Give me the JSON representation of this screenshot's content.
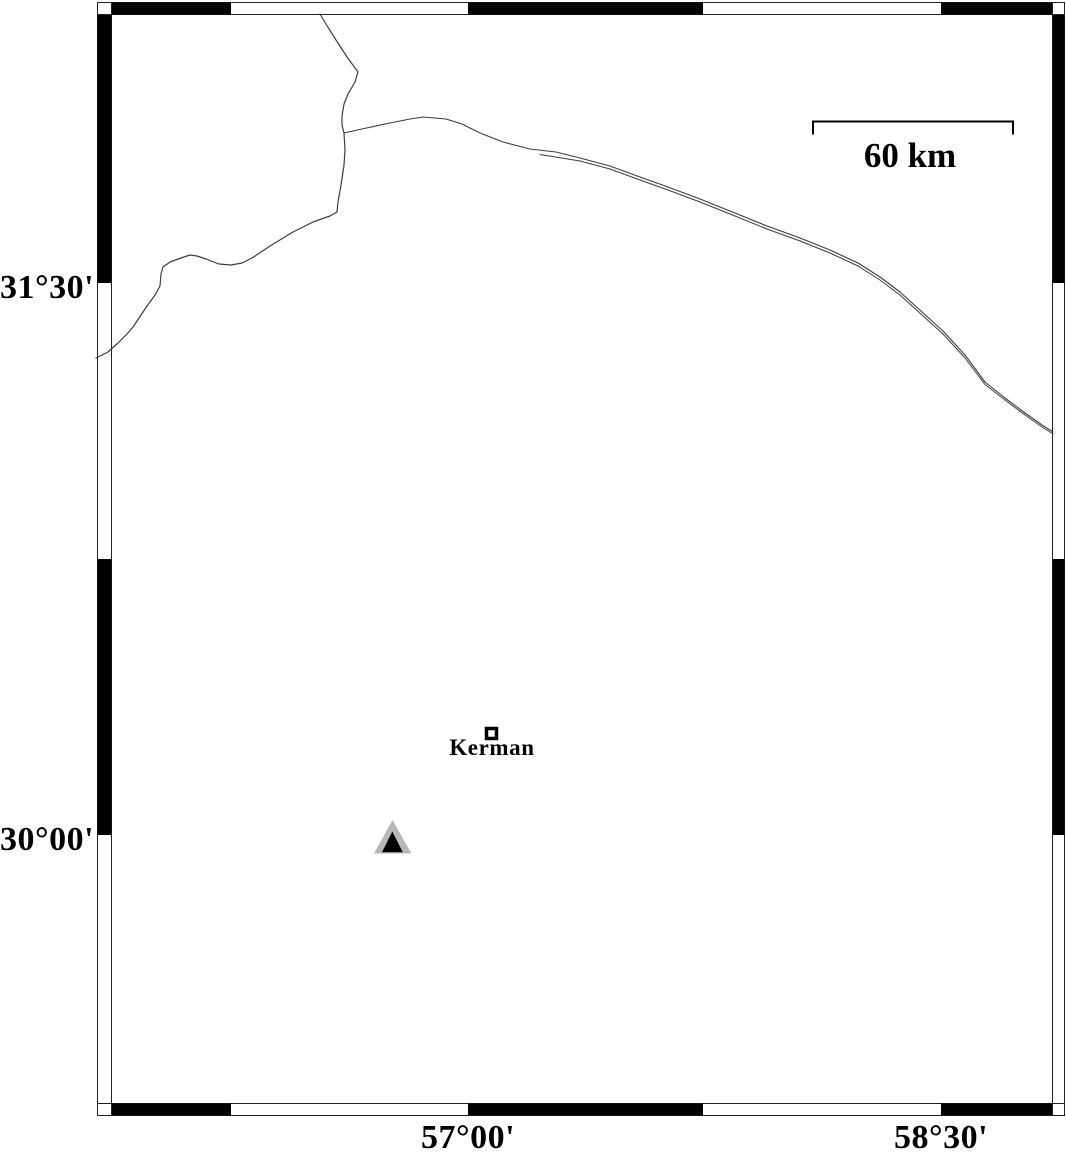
{
  "figure": {
    "kind": "geographic-map-plot",
    "description": "Black-and-white fancy-frame map with city marker, station triangle and road lines"
  },
  "axes": {
    "lat_ticks": [
      {
        "label": "31°30'"
      },
      {
        "label": "30°00'"
      }
    ],
    "lon_ticks": [
      {
        "label": "57°00'"
      },
      {
        "label": "58°30'"
      }
    ]
  },
  "scale_bar": {
    "label": "60 km"
  },
  "markers": {
    "city": {
      "label": "Kerman",
      "symbol": "open-square"
    },
    "station": {
      "symbol": "filled-triangle"
    }
  },
  "colors": {
    "frame": "#000000",
    "lines": "#3d3d3d",
    "station_fill": "#b8b8b8",
    "station_core": "#000000",
    "background": "#ffffff"
  }
}
